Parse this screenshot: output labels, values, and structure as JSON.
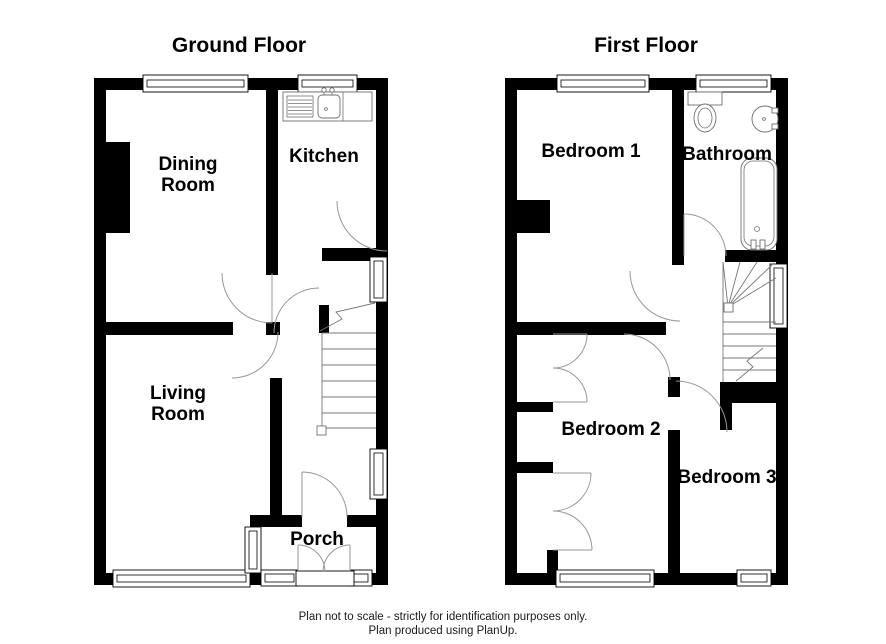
{
  "page": {
    "kind": "floor-plan",
    "background": "#ffffff"
  },
  "floors": {
    "ground": {
      "title": "Ground Floor",
      "rooms": {
        "dining": {
          "label_line1": "Dining",
          "label_line2": "Room"
        },
        "kitchen": {
          "label": "Kitchen"
        },
        "living": {
          "label_line1": "Living",
          "label_line2": "Room"
        },
        "porch": {
          "label": "Porch"
        }
      }
    },
    "first": {
      "title": "First Floor",
      "rooms": {
        "bedroom1": {
          "label": "Bedroom 1"
        },
        "bathroom": {
          "label": "Bathroom"
        },
        "bedroom2": {
          "label": "Bedroom 2"
        },
        "bedroom3": {
          "label": "Bedroom 3"
        }
      }
    }
  },
  "footer": {
    "line1": "Plan not to scale - strictly for identification purposes only.",
    "line2": "Plan produced using PlanUp."
  },
  "colors": {
    "wall": "#000000",
    "background": "#ffffff",
    "door_arc": "#979797",
    "fixture_line": "#6f6f6f",
    "window_line": "#000000",
    "text": "#000000"
  },
  "icons": [
    "window-icon",
    "door-swing-icon",
    "double-door-swing-icon",
    "staircase-icon",
    "kitchen-sink-icon",
    "toilet-icon",
    "wash-basin-icon",
    "bathtub-icon",
    "chimney-breast-icon"
  ]
}
